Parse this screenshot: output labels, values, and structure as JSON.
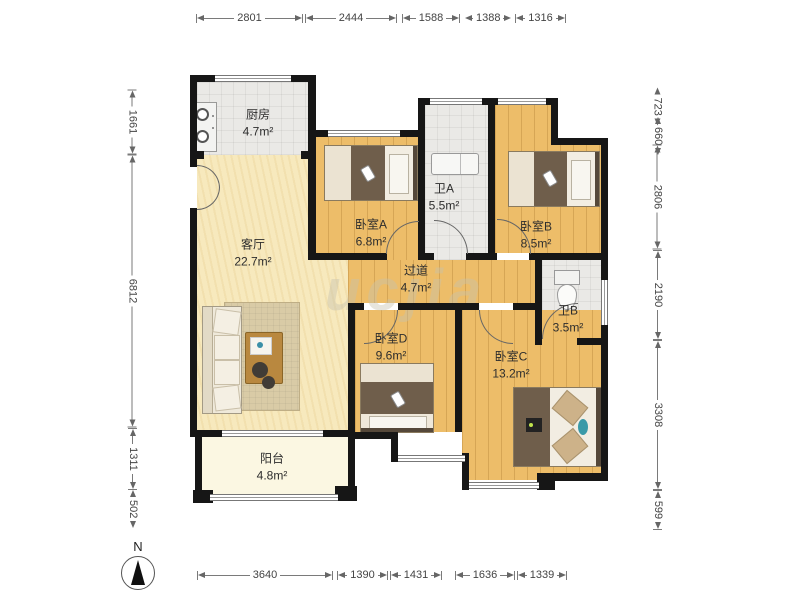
{
  "plan": {
    "rooms": [
      {
        "name": "厨房",
        "area": "4.7m²"
      },
      {
        "name": "客厅",
        "area": "22.7m²"
      },
      {
        "name": "阳台",
        "area": "4.8m²"
      },
      {
        "name": "卧室A",
        "area": "6.8m²"
      },
      {
        "name": "卫A",
        "area": "5.5m²"
      },
      {
        "name": "卧室B",
        "area": "8.5m²"
      },
      {
        "name": "过道",
        "area": "4.7m²"
      },
      {
        "name": "卫B",
        "area": "3.5m²"
      },
      {
        "name": "卧室D",
        "area": "9.6m²"
      },
      {
        "name": "卧室C",
        "area": "13.2m²"
      }
    ],
    "watermark": "ucjia"
  },
  "dims": {
    "top": [
      "2801",
      "2444",
      "1588",
      "1388",
      "1316"
    ],
    "bottom": [
      "3640",
      "1390",
      "1431",
      "1636",
      "1339"
    ],
    "left": [
      "1661",
      "6812",
      "1311",
      "502"
    ],
    "right": [
      "723",
      "660",
      "2806",
      "2190",
      "3308",
      "599"
    ]
  },
  "compass": {
    "north_label": "N"
  },
  "colors": {
    "wall": "#161616",
    "wood_floor": "#edbd69",
    "tile_floor": "#eae9e6",
    "living_floor": "#f7e9bd",
    "balcony_floor": "#fbf7e2",
    "dim_text": "#444444"
  }
}
